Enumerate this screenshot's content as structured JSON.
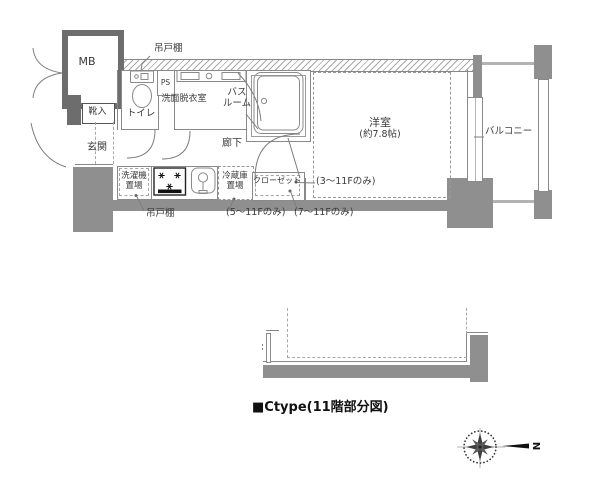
{
  "plan": {
    "rooms": {
      "mb": "MB",
      "shoe_box": "靴入",
      "entrance": "玄関",
      "toilet": "トイレ",
      "pipe_space": "PS",
      "washroom": "洗面脱衣室",
      "bathroom_line1": "バス",
      "bathroom_line2": "ルーム",
      "hallway": "廊下",
      "washer_line1": "洗濯機",
      "washer_line2": "置場",
      "fridge_line1": "冷蔵庫",
      "fridge_line2": "置場",
      "closet": "クローゼット",
      "western_room": "洋室",
      "western_room_size": "(約7.8帖)",
      "balcony": "バルコニー"
    },
    "annotations": {
      "hanging_cabinet_top": "吊戸棚",
      "hanging_cabinet_bottom": "吊戸棚",
      "floors_3_11": "(3〜11Fのみ)",
      "floors_5_11": "(5〜11Fのみ)",
      "floors_7_11": "(7〜11Fのみ)"
    }
  },
  "caption": "■Ctype(11階部分図)",
  "compass": {
    "north_label": "N"
  },
  "colors": {
    "wall": "#8f8f8f",
    "wall_dark": "#6d6d6d",
    "line": "#888888",
    "text": "#3a3a3a"
  }
}
